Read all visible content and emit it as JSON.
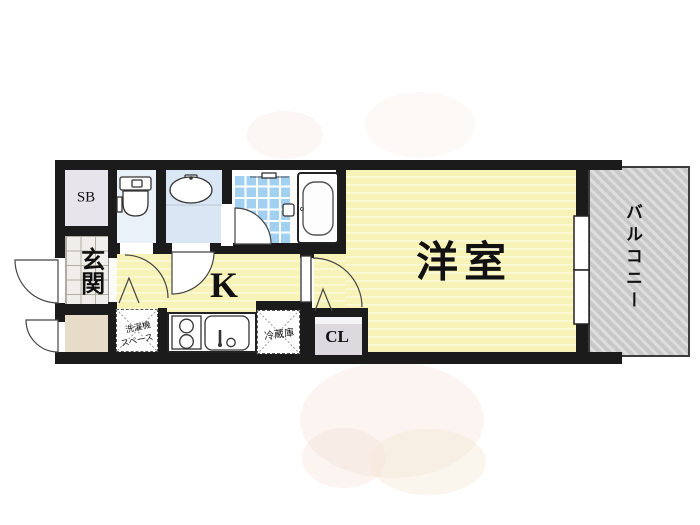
{
  "floorplan": {
    "type": "apartment-floorplan",
    "rooms": {
      "shoe_box": {
        "label": "SB"
      },
      "entrance": {
        "label": "玄関"
      },
      "kitchen": {
        "label": "K"
      },
      "western_room": {
        "label": "洋室"
      },
      "balcony": {
        "label": "バルコニー"
      },
      "closet": {
        "label": "CL"
      },
      "washer_space": {
        "label": "洗濯機スペース",
        "line1": "洗濯機",
        "line2": "スペース"
      },
      "refrigerator": {
        "label": "冷蔵庫"
      }
    },
    "icons": {
      "toilet": "toilet-icon",
      "wash_basin": "wash-basin-icon",
      "bathtub": "bathtub-icon",
      "shower_room": "shower-tile-area",
      "stove": "stove-burners-icon",
      "kitchen_sink": "kitchen-sink-icon",
      "window": "balcony-window",
      "doors": "door-swing-arc"
    },
    "colors": {
      "wall": "#1b1b1b",
      "room_yellow": "#f7f2b6",
      "room_yellow_stripe": "#fbf8d4",
      "bath_tile": "#a2d0f0",
      "toilet_room": "#ebf1f8",
      "powder_room": "#d9e6f3",
      "shoe_box_fill": "#e8e4ec",
      "closet_fill": "#dcdade",
      "entrance_storage_fill": "#e7dcc8",
      "balcony_fill": "#c8c8c8",
      "balcony_stripe": "#dedede",
      "line": "#3c3c3c"
    }
  }
}
